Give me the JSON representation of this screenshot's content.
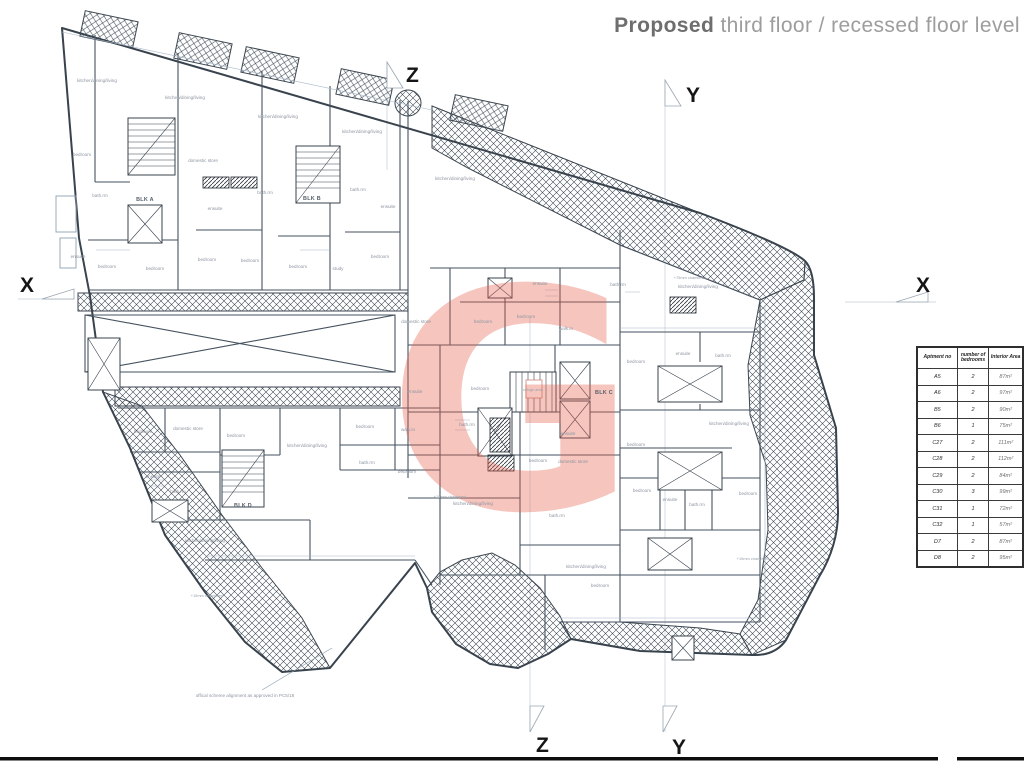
{
  "title": {
    "emphasis": "Proposed",
    "rest": " third floor / recessed floor level"
  },
  "markers": {
    "x": "X",
    "y": "Y",
    "z": "Z"
  },
  "note": "offical scheme alignment as approved in PC5/18",
  "watermark": {
    "letter": "G",
    "color": "#e4604e"
  },
  "colors": {
    "wall": "#46525f",
    "hatch": "#3c4650",
    "label": "#8d95a1",
    "title_bold": "#6e6e6e",
    "title_light": "#9d9d9d"
  },
  "legend_table": {
    "headers": [
      "Aptment no",
      "number of bedrooms",
      "Interior Area"
    ],
    "rows": [
      [
        "A5",
        "2",
        "87m²"
      ],
      [
        "A6",
        "2",
        "97m²"
      ],
      [
        "B5",
        "2",
        "90m²"
      ],
      [
        "B6",
        "1",
        "75m²"
      ],
      [
        "C27",
        "2",
        "111m²"
      ],
      [
        "C28",
        "2",
        "112m²"
      ],
      [
        "C29",
        "2",
        "84m²"
      ],
      [
        "C30",
        "3",
        "99m²"
      ],
      [
        "C31",
        "1",
        "72m²"
      ],
      [
        "C32",
        "1",
        "57m²"
      ],
      [
        "D7",
        "2",
        "87m²"
      ],
      [
        "D8",
        "2",
        "95m²"
      ]
    ]
  },
  "plan": {
    "room_labels": [
      {
        "t": "kitchen/dining/living",
        "x": 97,
        "y": 82
      },
      {
        "t": "kitchen/dining/living",
        "x": 185,
        "y": 99
      },
      {
        "t": "kitchen/dining/living",
        "x": 278,
        "y": 118
      },
      {
        "t": "kitchen/dining/living",
        "x": 362,
        "y": 133
      },
      {
        "t": "kitchen/dining/living",
        "x": 455,
        "y": 180
      },
      {
        "t": "kitchen/dining/living",
        "x": 698,
        "y": 288
      },
      {
        "t": "kitchen/dining/living",
        "x": 307,
        "y": 447
      },
      {
        "t": "kitchen/dining/living",
        "x": 205,
        "y": 542
      },
      {
        "t": "kitchen/dining/living",
        "x": 473,
        "y": 505
      },
      {
        "t": "kitchen/dining/living",
        "x": 586,
        "y": 568
      },
      {
        "t": "kitchen/dining/living",
        "x": 729,
        "y": 425
      },
      {
        "t": "bedroom",
        "x": 82,
        "y": 156
      },
      {
        "t": "bedroom",
        "x": 107,
        "y": 268
      },
      {
        "t": "bedroom",
        "x": 155,
        "y": 270
      },
      {
        "t": "bedroom",
        "x": 207,
        "y": 261
      },
      {
        "t": "bedroom",
        "x": 250,
        "y": 262
      },
      {
        "t": "bedroom",
        "x": 298,
        "y": 268
      },
      {
        "t": "bedroom",
        "x": 380,
        "y": 258
      },
      {
        "t": "bedroom",
        "x": 483,
        "y": 323
      },
      {
        "t": "bedroom",
        "x": 526,
        "y": 318
      },
      {
        "t": "bedroom",
        "x": 480,
        "y": 390
      },
      {
        "t": "bedroom",
        "x": 407,
        "y": 473
      },
      {
        "t": "bedroom",
        "x": 538,
        "y": 462
      },
      {
        "t": "bedroom",
        "x": 636,
        "y": 363
      },
      {
        "t": "bedroom",
        "x": 636,
        "y": 446
      },
      {
        "t": "bedroom",
        "x": 642,
        "y": 492
      },
      {
        "t": "bedroom",
        "x": 748,
        "y": 495
      },
      {
        "t": "bedroom",
        "x": 600,
        "y": 587
      },
      {
        "t": "bedroom",
        "x": 143,
        "y": 433
      },
      {
        "t": "bedroom",
        "x": 236,
        "y": 437
      },
      {
        "t": "bedroom",
        "x": 365,
        "y": 428
      },
      {
        "t": "study",
        "x": 338,
        "y": 270
      },
      {
        "t": "domestic store",
        "x": 203,
        "y": 162
      },
      {
        "t": "domestic store",
        "x": 416,
        "y": 323
      },
      {
        "t": "domestic store",
        "x": 573,
        "y": 463
      },
      {
        "t": "domestic store",
        "x": 188,
        "y": 430
      },
      {
        "t": "bath.rm",
        "x": 100,
        "y": 197
      },
      {
        "t": "bath.rm",
        "x": 265,
        "y": 194
      },
      {
        "t": "bath.rm",
        "x": 358,
        "y": 191
      },
      {
        "t": "bath.rm",
        "x": 618,
        "y": 286
      },
      {
        "t": "bath.rm",
        "x": 467,
        "y": 426
      },
      {
        "t": "bath.rm",
        "x": 557,
        "y": 517
      },
      {
        "t": "bath.rm",
        "x": 178,
        "y": 493
      },
      {
        "t": "bath.rm",
        "x": 367,
        "y": 464
      },
      {
        "t": "bath.rm",
        "x": 697,
        "y": 506
      },
      {
        "t": "bath.rm",
        "x": 723,
        "y": 357
      },
      {
        "t": "ensuite",
        "x": 78,
        "y": 258
      },
      {
        "t": "ensuite",
        "x": 215,
        "y": 210
      },
      {
        "t": "ensuite",
        "x": 388,
        "y": 208
      },
      {
        "t": "ensuite",
        "x": 415,
        "y": 393
      },
      {
        "t": "ensuite",
        "x": 540,
        "y": 285
      },
      {
        "t": "ensuite",
        "x": 568,
        "y": 435
      },
      {
        "t": "ensuite",
        "x": 670,
        "y": 501
      },
      {
        "t": "ensuite",
        "x": 153,
        "y": 478
      },
      {
        "t": "ensuite",
        "x": 683,
        "y": 355
      },
      {
        "t": "walk.in",
        "x": 566,
        "y": 330
      },
      {
        "t": "walk.in",
        "x": 408,
        "y": 431
      },
      {
        "t": "BLK A",
        "x": 145,
        "y": 201,
        "k": "blk"
      },
      {
        "t": "BLK B",
        "x": 312,
        "y": 200,
        "k": "blk"
      },
      {
        "t": "BLK C",
        "x": 604,
        "y": 394,
        "k": "blk"
      },
      {
        "t": "BLK D",
        "x": 243,
        "y": 507,
        "k": "blk"
      },
      {
        "t": "+75mm chamfered",
        "x": 690,
        "y": 279,
        "k": "note"
      },
      {
        "t": "+15mm chamfered",
        "x": 450,
        "y": 498,
        "k": "note"
      },
      {
        "t": "+15mm chamfered",
        "x": 207,
        "y": 597,
        "k": "note"
      },
      {
        "t": "+15mm chamfered",
        "x": 753,
        "y": 560,
        "k": "note"
      },
      {
        "t": "refuge area",
        "x": 533,
        "y": 391,
        "k": "note"
      }
    ]
  }
}
